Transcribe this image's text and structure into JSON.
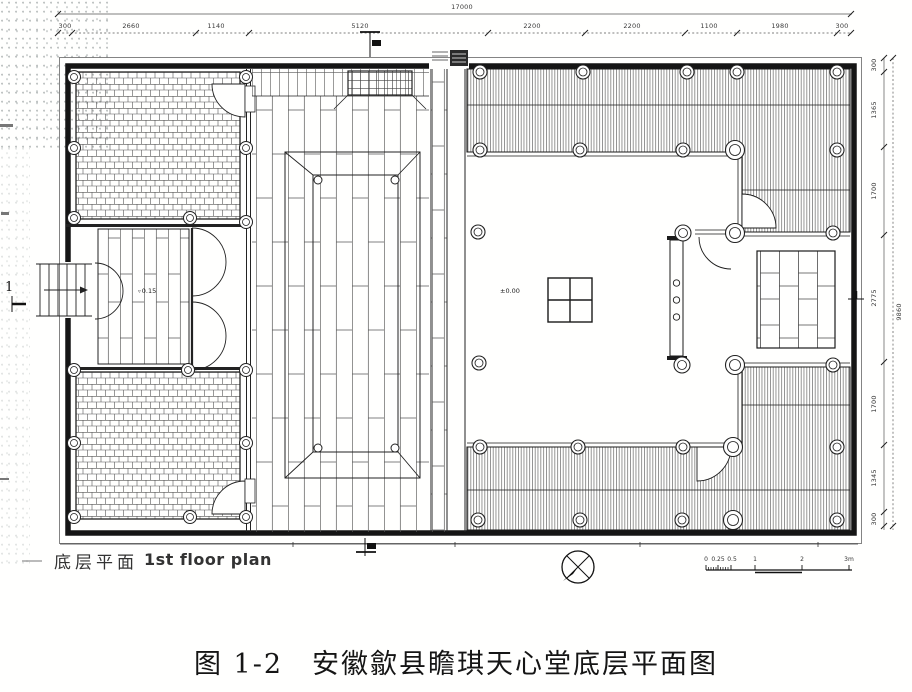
{
  "figure": {
    "caption": "图 1-2　安徽歙县瞻琪天心堂底层平面图",
    "plan_label_cn": "底层平面",
    "plan_label_en": "1st floor plan"
  },
  "dimensions": {
    "top_total": "17000",
    "top_segments": [
      "300",
      "2660",
      "1140",
      "5120",
      "2200",
      "2200",
      "1100",
      "1980",
      "300"
    ],
    "right_total": "9860",
    "right_segments": [
      "300",
      "1365",
      "1700",
      "2775",
      "1700",
      "1345",
      "300"
    ]
  },
  "annotations": {
    "courtyard_elevation": "±0.00",
    "hall_elevation": "0.15",
    "section_label_left": "1"
  },
  "scale_bar": {
    "labels": [
      "0",
      "0.25",
      "0.5",
      "1",
      "2",
      "3m"
    ]
  },
  "colors": {
    "ink": "#1b1b1b",
    "paper": "#fffffe"
  }
}
